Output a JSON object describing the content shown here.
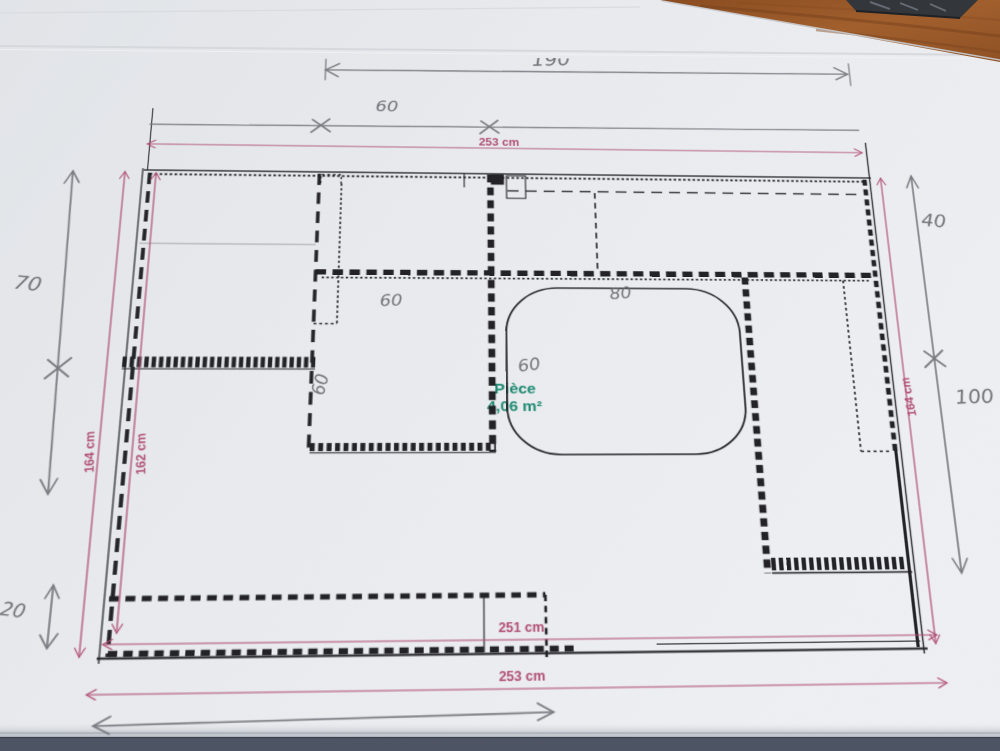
{
  "printed_dimensions": {
    "top_width": "253 cm",
    "left_outer": "164 cm",
    "left_inner": "162 cm",
    "right_side": "164 cm",
    "bottom_inner": "251 cm",
    "bottom_outer": "253 cm"
  },
  "handwritten": {
    "top_span": "190",
    "top_left_segment": "60",
    "left_upper": "70",
    "left_lower": "20",
    "right_upper": "40",
    "right_lower": "100",
    "closet_width": "60",
    "closet_depth": "60",
    "door_width": "60",
    "table_width": "80"
  },
  "room_label": {
    "name": "Pièce",
    "area": "4,06 m²"
  },
  "colors": {
    "paper": "#e8eaed",
    "print_ink": "#232327",
    "pencil_gray": "#76767d",
    "dimension_pink": "#b04e74",
    "room_green": "#1f8a72",
    "desk_wood": "#9a5a2c",
    "bottom_edge": "#4d5564"
  }
}
